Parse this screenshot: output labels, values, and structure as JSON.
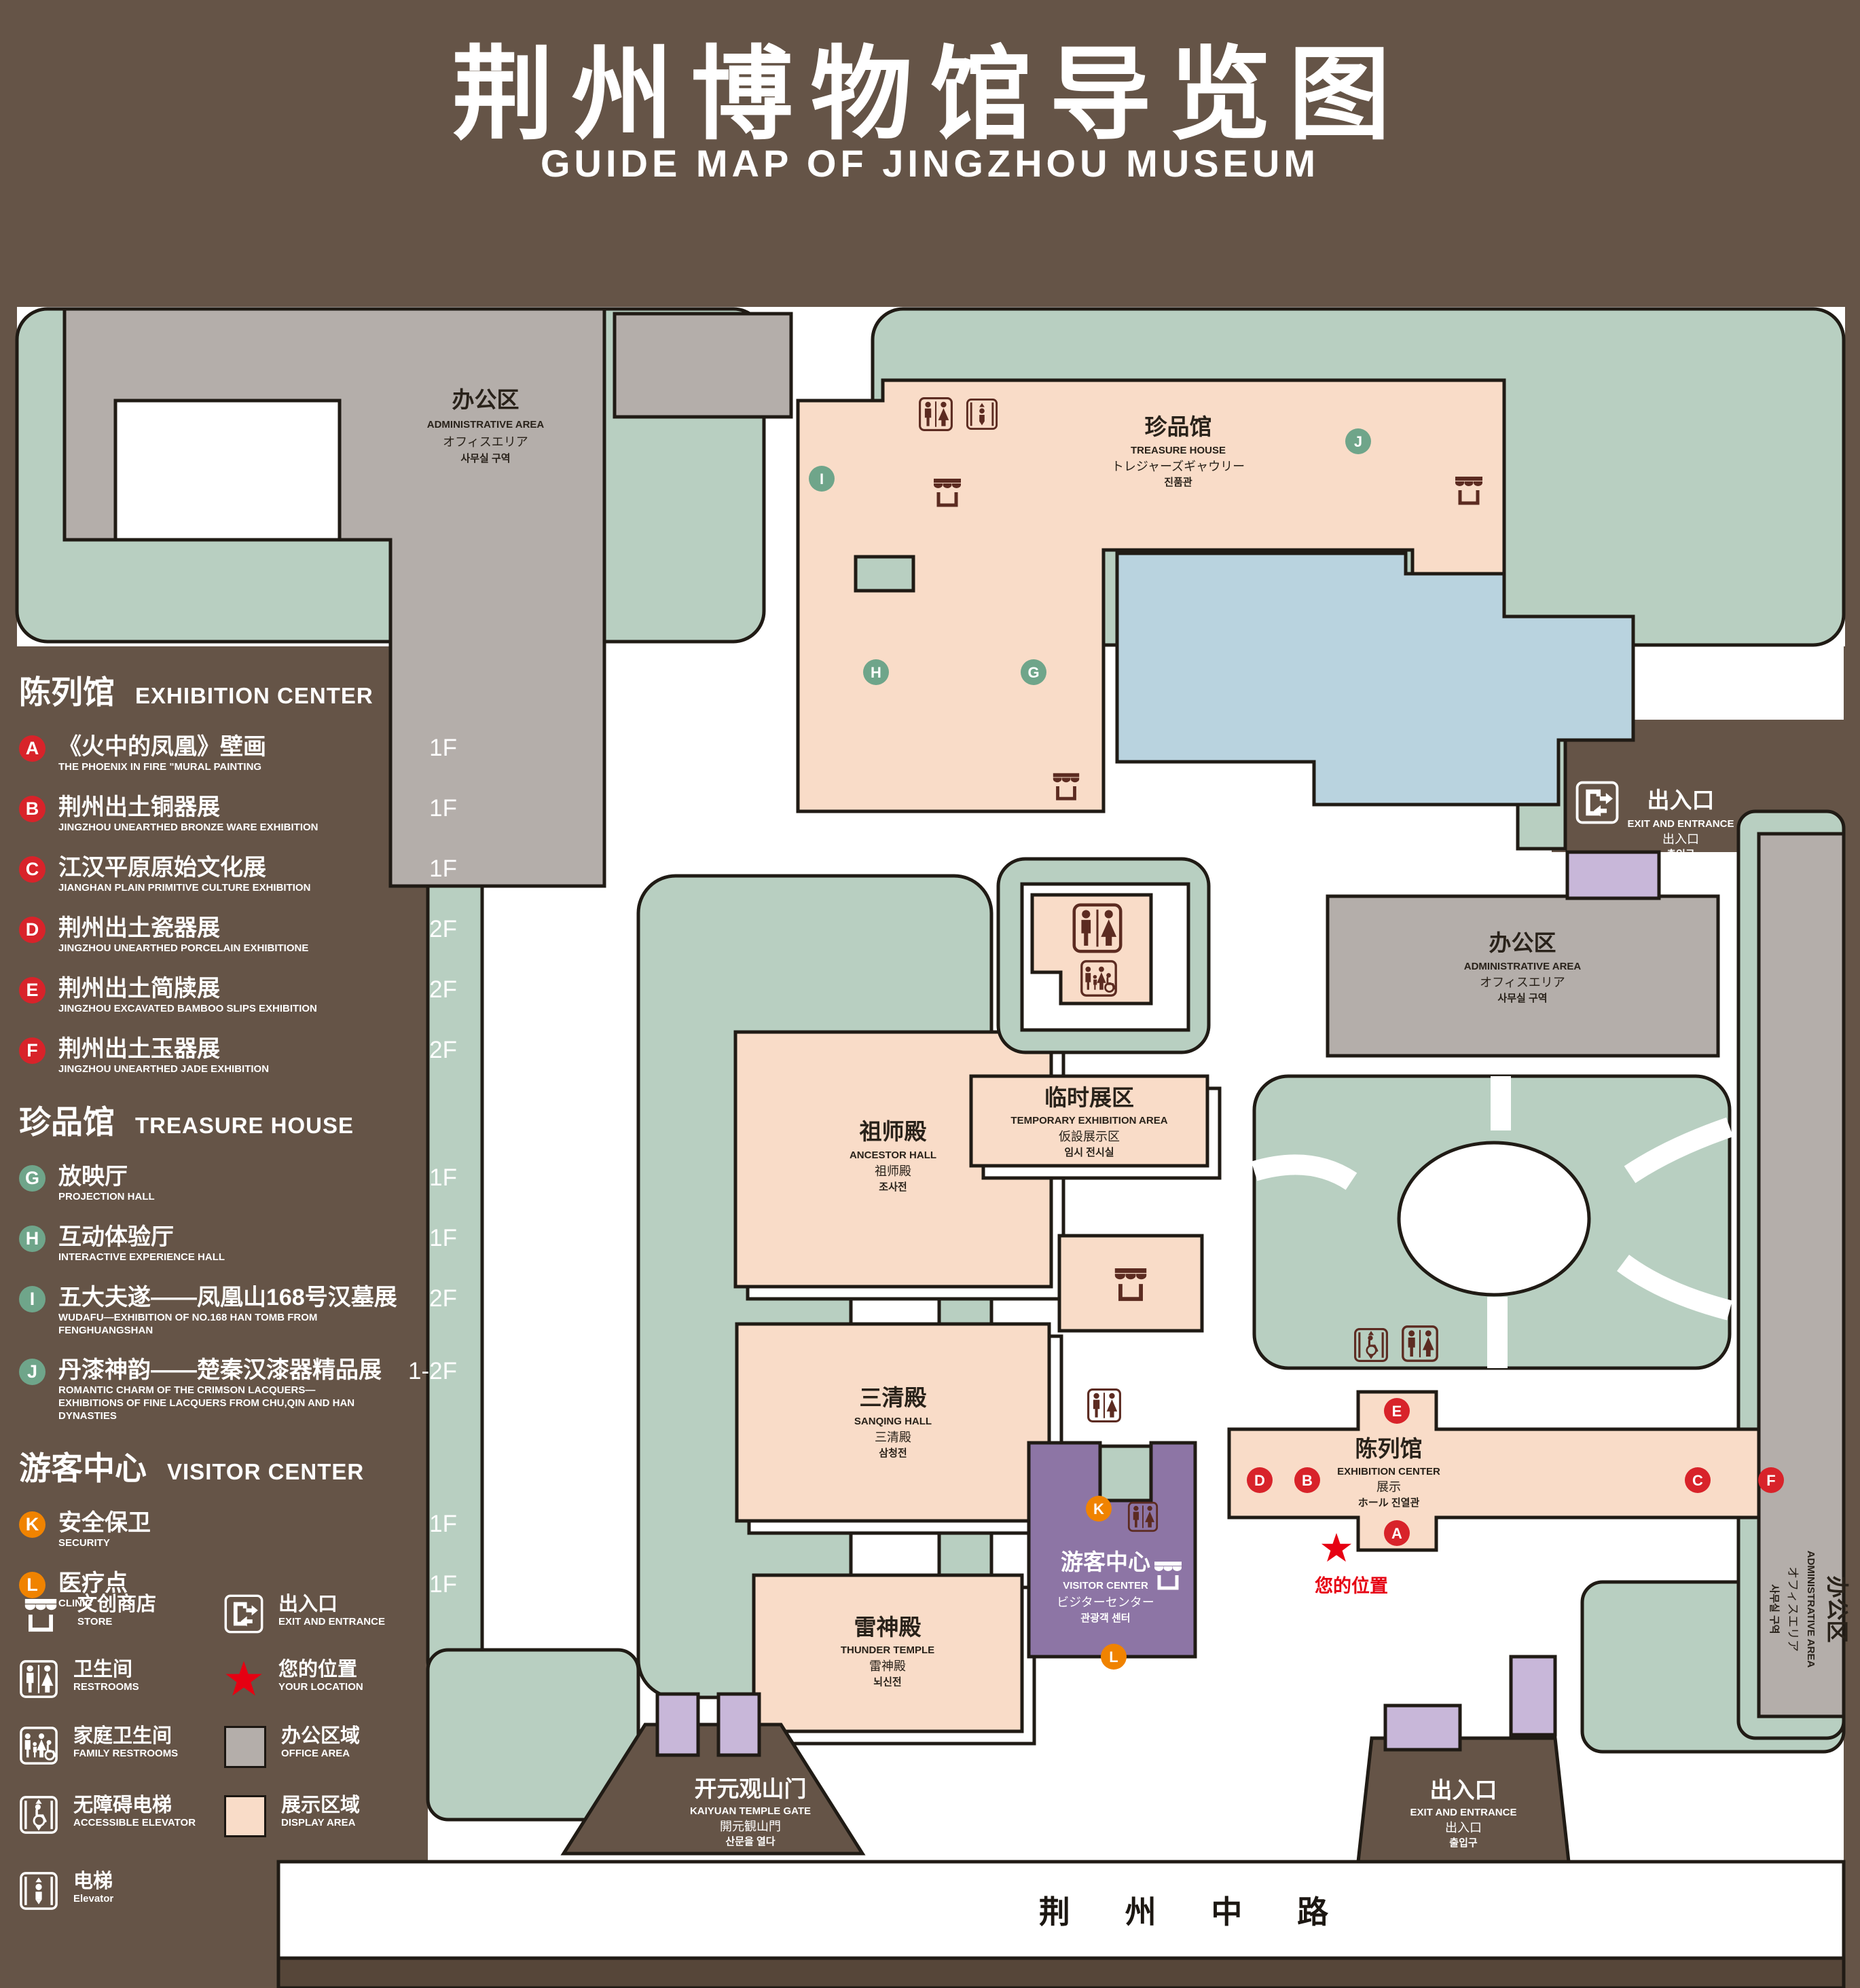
{
  "header": {
    "title_zh": "荆州博物馆导览图",
    "title_en": "GUIDE MAP OF JINGZHOU MUSEUM"
  },
  "colors": {
    "background": "#655447",
    "green_area": "#b8cfc1",
    "office_gray": "#b4aeaa",
    "display_pink": "#f9dcc8",
    "pond_blue": "#b9d3df",
    "visitor_purple": "#8d75a5",
    "entrance_lavender": "#c8b7d9",
    "badge_red": "#d8232a",
    "badge_green": "#6fa58a",
    "badge_orange": "#f08300",
    "icon_maroon": "#5c2b21",
    "location_red": "#e60012"
  },
  "legend": {
    "sections": [
      {
        "title_zh": "陈列馆",
        "title_en": "EXHIBITION CENTER",
        "items": [
          {
            "letter": "A",
            "zh": "《火中的凤凰》壁画",
            "en": "THE PHOENIX IN FIRE \"MURAL PAINTING",
            "floor": "1F"
          },
          {
            "letter": "B",
            "zh": "荆州出土铜器展",
            "en": "JINGZHOU UNEARTHED BRONZE WARE EXHIBITION",
            "floor": "1F"
          },
          {
            "letter": "C",
            "zh": "江汉平原原始文化展",
            "en": "JIANGHAN PLAIN PRIMITIVE CULTURE EXHIBITION",
            "floor": "1F"
          },
          {
            "letter": "D",
            "zh": "荆州出土瓷器展",
            "en": "JINGZHOU UNEARTHED PORCELAIN EXHIBITIONE",
            "floor": "2F"
          },
          {
            "letter": "E",
            "zh": "荆州出土简牍展",
            "en": "JINGZHOU EXCAVATED BAMBOO SLIPS EXHIBITION",
            "floor": "2F"
          },
          {
            "letter": "F",
            "zh": "荆州出土玉器展",
            "en": "JINGZHOU UNEARTHED JADE EXHIBITION",
            "floor": "2F"
          }
        ]
      },
      {
        "title_zh": "珍品馆",
        "title_en": "TREASURE HOUSE",
        "items": [
          {
            "letter": "G",
            "zh": "放映厅",
            "en": "PROJECTION HALL",
            "floor": "1F"
          },
          {
            "letter": "H",
            "zh": "互动体验厅",
            "en": "INTERACTIVE EXPERIENCE HALL",
            "floor": "1F"
          },
          {
            "letter": "I",
            "zh": "五大夫遂——凤凰山168号汉墓展",
            "en": "WUDAFU—EXHIBITION OF NO.168 HAN TOMB FROM FENGHUANGSHAN",
            "floor": "2F"
          },
          {
            "letter": "J",
            "zh": "丹漆神韵——楚秦汉漆器精品展",
            "en": "ROMANTIC CHARM OF THE CRIMSON LACQUERS—EXHIBITIONS OF FINE LACQUERS FROM CHU,QIN AND HAN DYNASTIES",
            "floor": "1-2F"
          }
        ]
      },
      {
        "title_zh": "游客中心",
        "title_en": "VISITOR CENTER",
        "items": [
          {
            "letter": "K",
            "zh": "安全保卫",
            "en": "SECURITY",
            "floor": "1F"
          },
          {
            "letter": "L",
            "zh": "医疗点",
            "en": "CLINIC",
            "floor": "1F"
          }
        ]
      }
    ],
    "symbols_left": [
      {
        "icon": "store-icon",
        "zh": "文创商店",
        "en": "STORE"
      },
      {
        "icon": "restrooms-icon",
        "zh": "卫生间",
        "en": "RESTROOMS"
      },
      {
        "icon": "family-restrooms-icon",
        "zh": "家庭卫生间",
        "en": "FAMILY RESTROOMS"
      },
      {
        "icon": "accessible-elevator-icon",
        "zh": "无障碍电梯",
        "en": "ACCESSIBLE ELEVATOR"
      },
      {
        "icon": "elevator-icon",
        "zh": "电梯",
        "en": "Elevator"
      }
    ],
    "symbols_right": [
      {
        "icon": "exit-entrance-icon",
        "zh": "出入口",
        "en": "EXIT AND ENTRANCE"
      },
      {
        "icon": "your-location-star",
        "zh": "您的位置",
        "en": "YOUR LOCATION"
      },
      {
        "icon": "office-area-swatch",
        "zh": "办公区域",
        "en": "OFFICE AREA"
      },
      {
        "icon": "display-area-swatch",
        "zh": "展示区域",
        "en": "DISPLAY AREA"
      }
    ]
  },
  "map": {
    "buildings": {
      "office": {
        "zh": "办公区",
        "en": "ADMINISTRATIVE AREA",
        "ja": "オフィスエリア",
        "ko": "사무실 구역"
      },
      "treasure": {
        "zh": "珍品馆",
        "en": "TREASURE HOUSE",
        "ja": "トレジャーズギャウリー",
        "ko": "진품관"
      },
      "ancestor": {
        "zh": "祖师殿",
        "en": "ANCESTOR HALL",
        "ja": "祖师殿",
        "ko": "조사전"
      },
      "sanqing": {
        "zh": "三清殿",
        "en": "SANQING HALL",
        "ja": "三清殿",
        "ko": "삼청전"
      },
      "thunder": {
        "zh": "雷神殿",
        "en": "THUNDER TEMPLE",
        "ja": "雷神殿",
        "ko": "뇌신전"
      },
      "temporary": {
        "zh": "临时展区",
        "en": "TEMPORARY EXHIBITION AREA",
        "ja": "仮設展示区",
        "ko": "임시 전시실"
      },
      "visitor": {
        "zh": "游客中心",
        "en": "VISITOR CENTER",
        "ja": "ビジターセンター",
        "ko": "관광객 센터"
      },
      "exhibition": {
        "zh": "陈列馆",
        "en": "EXHIBITION CENTER",
        "ja": "展示",
        "ko": "ホール 진열관"
      },
      "gate": {
        "zh": "开元观山门",
        "en": "KAIYUAN TEMPLE GATE",
        "ja": "開元観山門",
        "ko": "산문을 열다"
      },
      "exit": {
        "zh": "出入口",
        "en": "EXIT AND ENTRANCE",
        "ja": "出入口",
        "ko": "출입구"
      }
    },
    "markers": {
      "a": "A",
      "b": "B",
      "c": "C",
      "d": "D",
      "e": "E",
      "f": "F",
      "g": "G",
      "h": "H",
      "i": "I",
      "j": "J",
      "k": "K",
      "l": "L"
    },
    "your_location": "您的位置",
    "road": "荆 州 中 路"
  }
}
